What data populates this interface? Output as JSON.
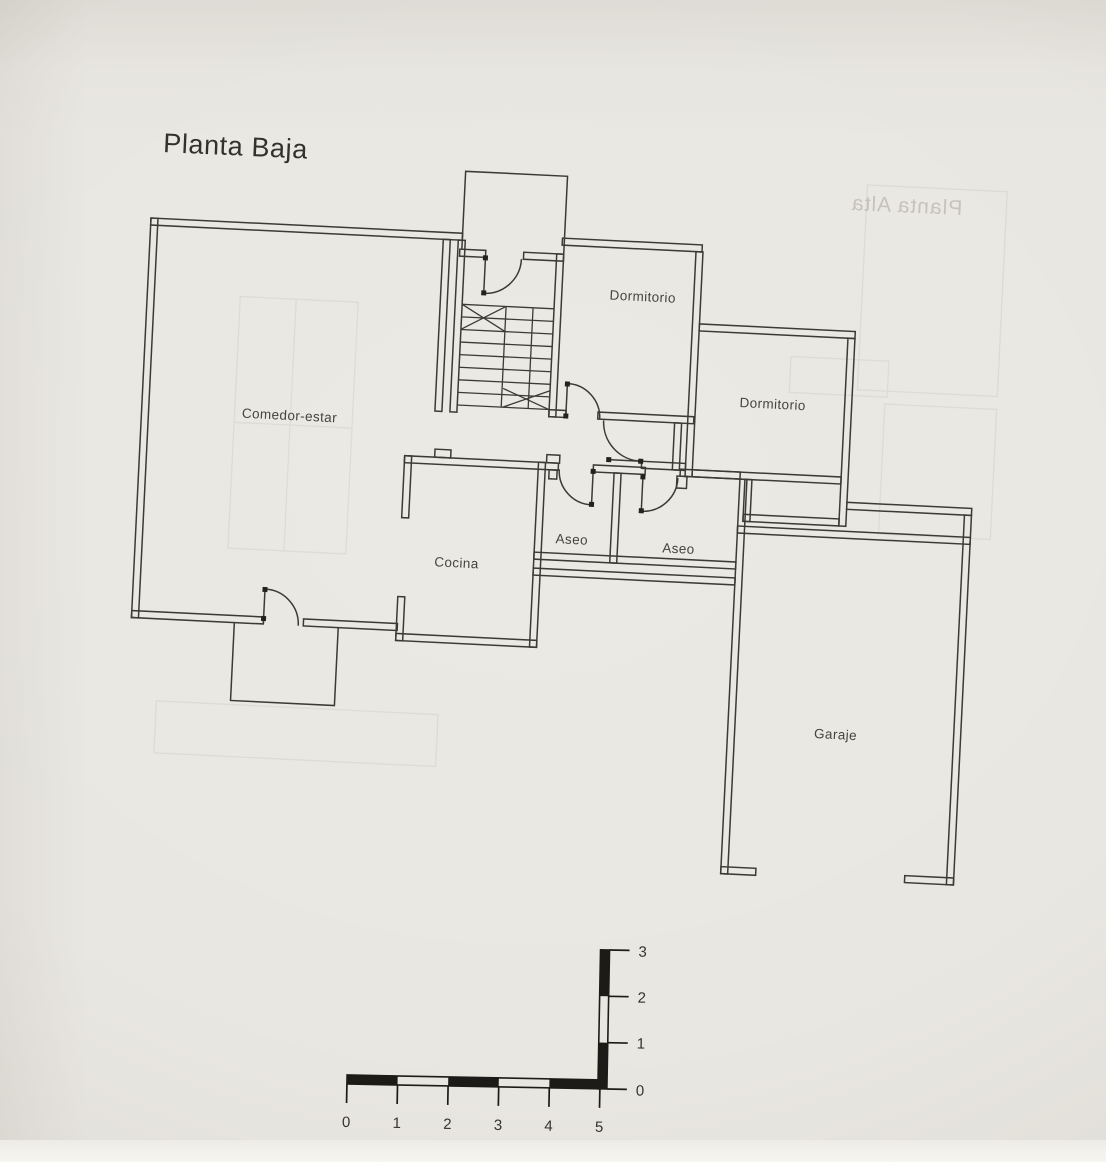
{
  "title": "Planta Baja",
  "ghost": {
    "reverse_side_title": "Planta Alta"
  },
  "rooms": {
    "comedor": {
      "label": "Comedor-estar"
    },
    "cocina": {
      "label": "Cocina"
    },
    "dormitorio1": {
      "label": "Dormitorio"
    },
    "dormitorio2": {
      "label": "Dormitorio"
    },
    "aseo1": {
      "label": "Aseo"
    },
    "aseo2": {
      "label": "Aseo"
    },
    "garaje": {
      "label": "Garaje"
    }
  },
  "scale_bar": {
    "horizontal_labels": [
      "0",
      "1",
      "2",
      "3",
      "4",
      "5"
    ],
    "vertical_labels": [
      "0",
      "1",
      "2",
      "3"
    ]
  },
  "colors": {
    "paper": "#e9e7e1",
    "ink": "#3b3a36",
    "scale_ink": "#1c1b18",
    "label_ink": "#45443e"
  }
}
